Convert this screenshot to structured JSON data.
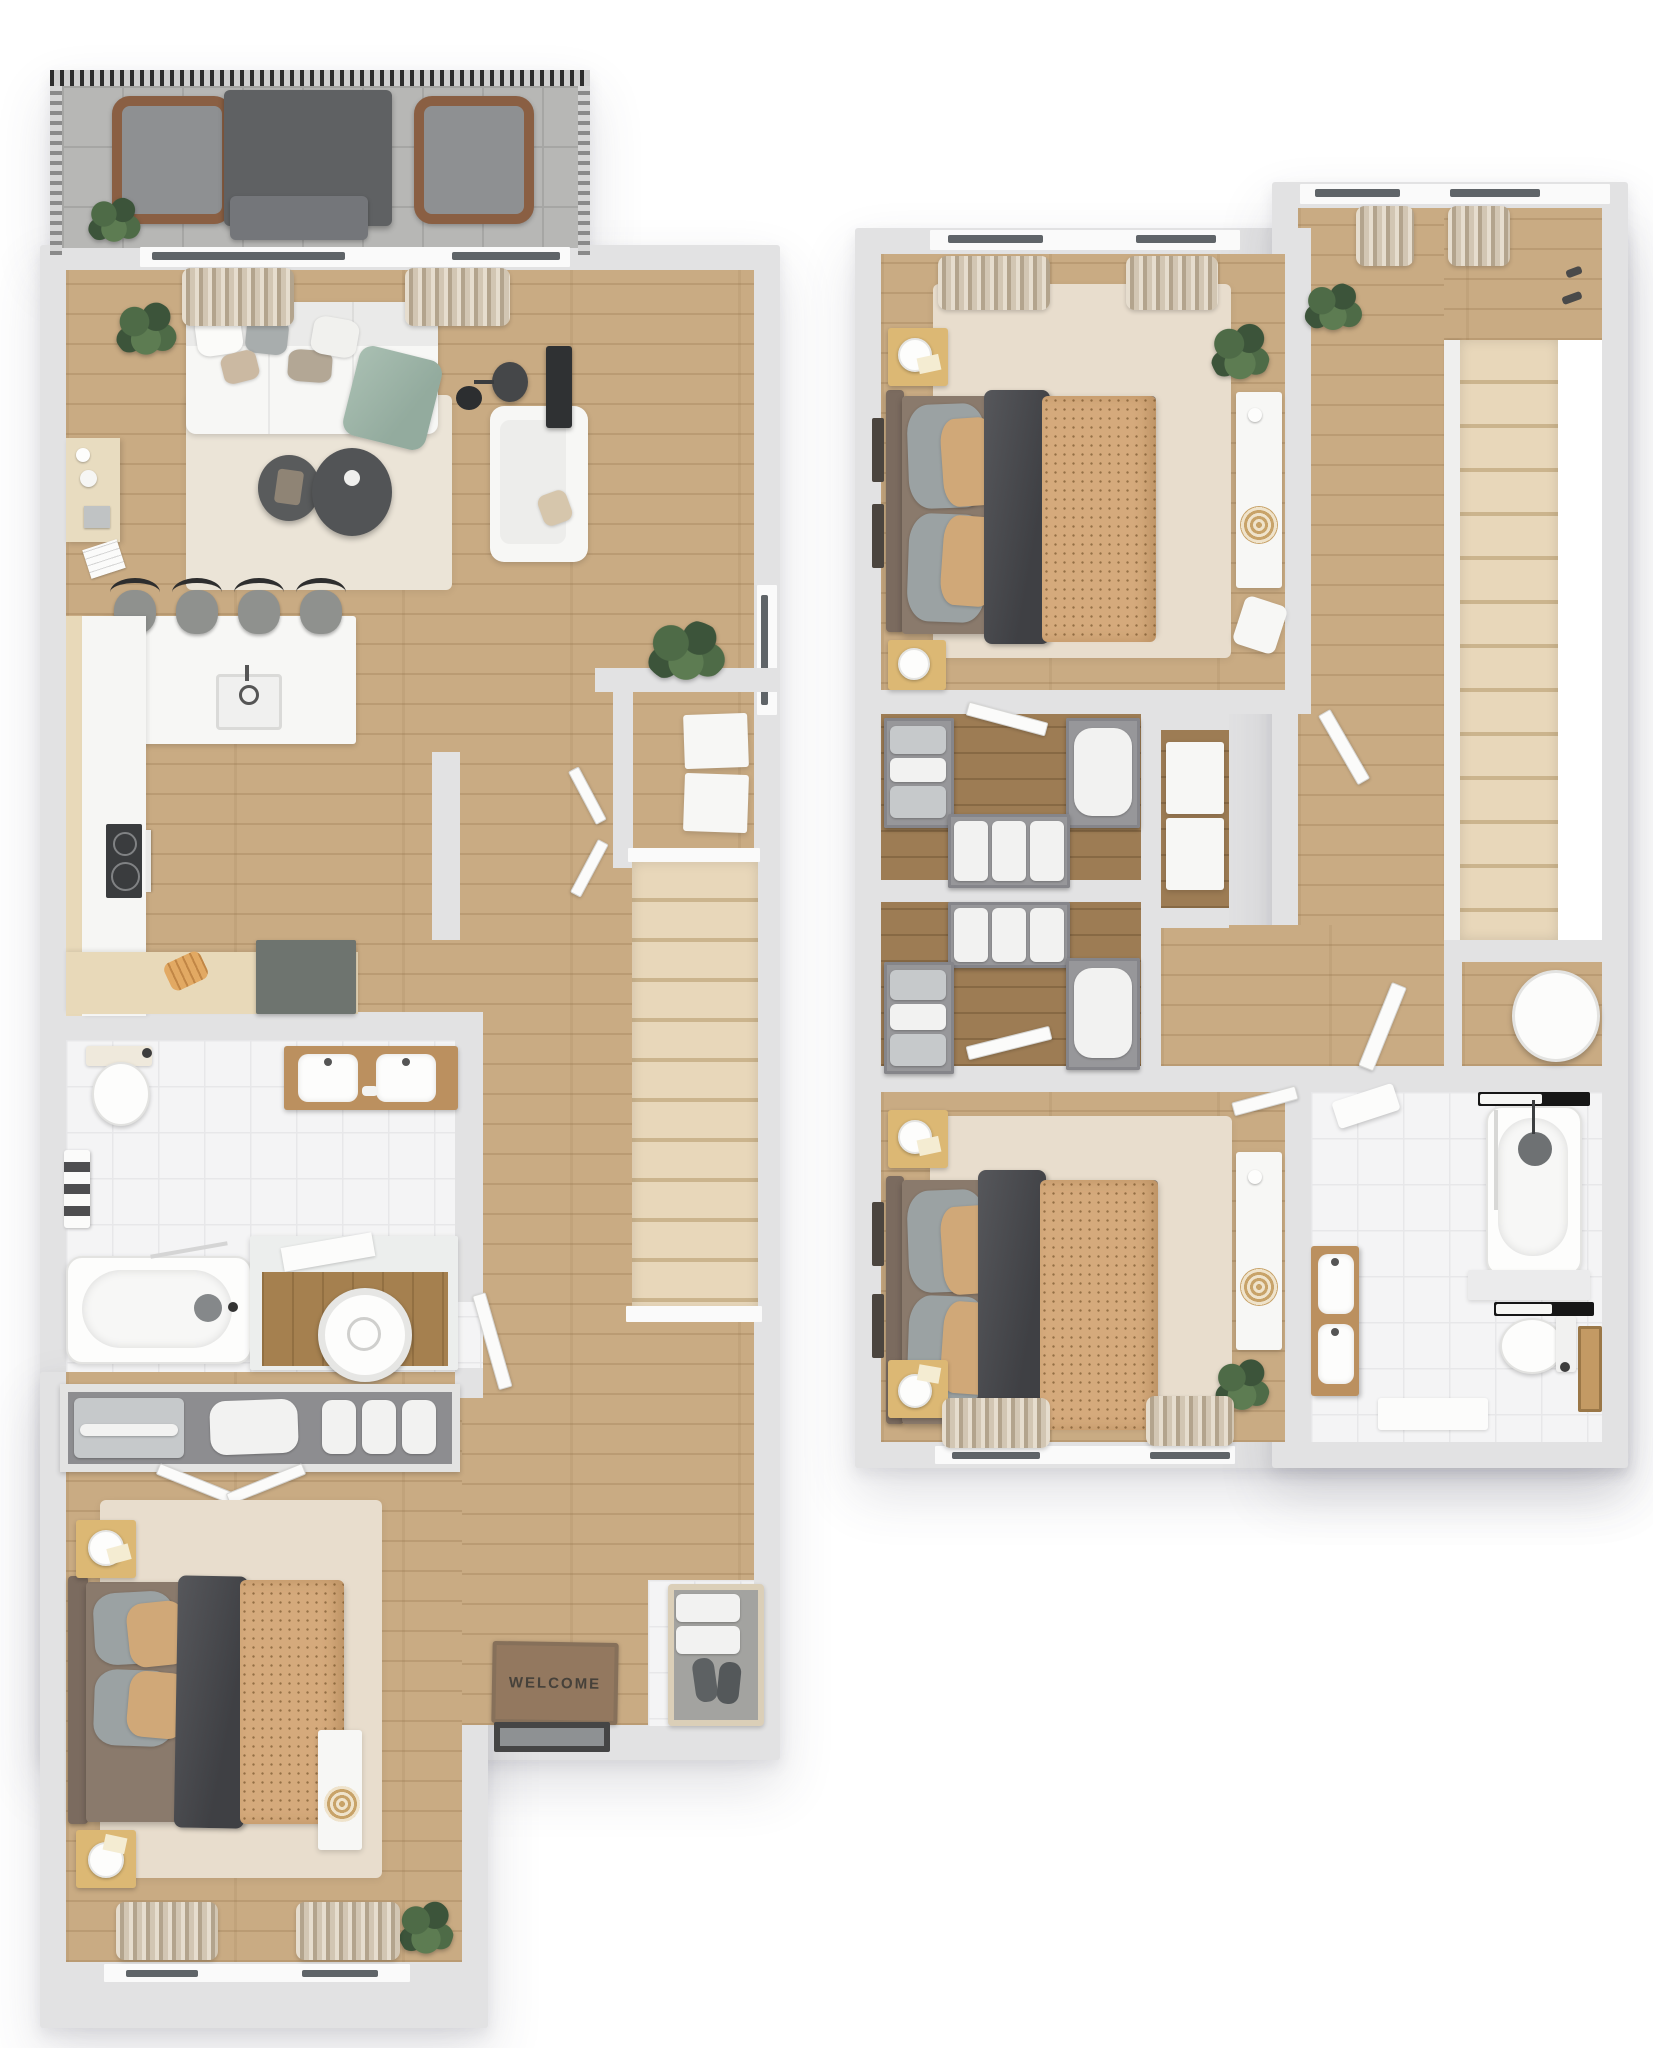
{
  "plan": {
    "welcome_mat_text": "WELCOME"
  },
  "colors": {
    "wall": "#e2e2e3",
    "floor_wood": "#c9ab83",
    "closet_wood": "#9d7c54",
    "tile": "#f4f4f5",
    "tile_line": "#e7e7e9",
    "balcony_tile": "#b7b7b5",
    "balcony_line": "#a6a6a4",
    "rug": "#e8ddcd",
    "stair_wood": "#e8d7ba",
    "stair_seam": "#cbb48d",
    "duvet": "#d5aa7c",
    "blanket": "#56575b",
    "pillow_gray": "#9ba2a3",
    "pillow_tan": "#d0a878",
    "headboard": "#7b6b5f",
    "bed_base": "#8a7a6c",
    "white_furn": "#f7f7f5",
    "wood_furn": "#dcb874",
    "vanity_wood": "#bb905f",
    "counter_beige": "#e8d9b9",
    "dark_unit": "#6e746f",
    "charcoal": "#2f3133",
    "green_throw": "#a9bfb2",
    "plant": "#4e6b47",
    "plant_dark": "#3c543a",
    "mat": "#93785f",
    "mat_text": "#46413a",
    "glass": "#5f6468",
    "black": "#161616"
  }
}
